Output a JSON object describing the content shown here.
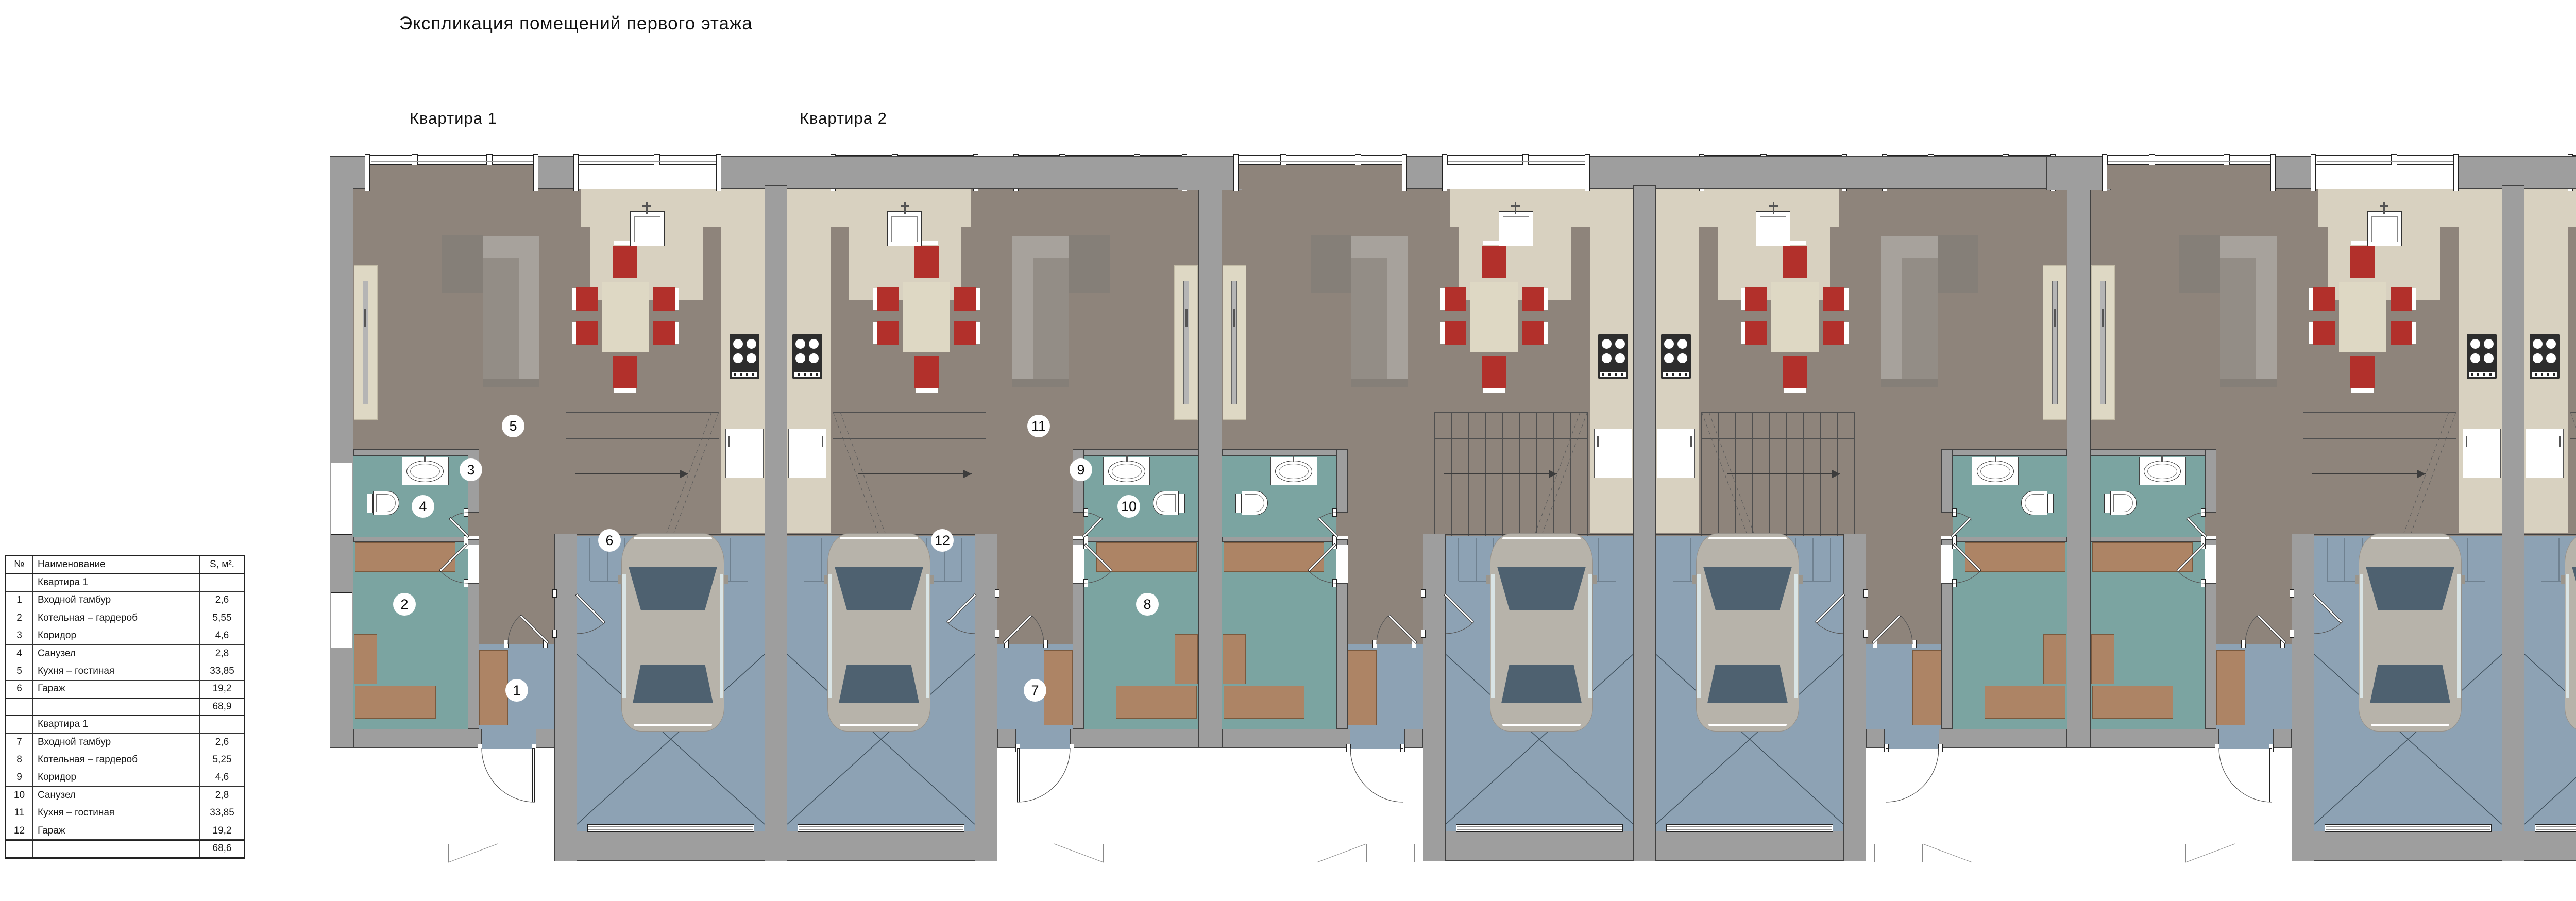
{
  "title": "Экспликация помещений первого этажа",
  "apartment_labels": [
    {
      "label": "Квартира 1"
    },
    {
      "label": "Квартира 2"
    }
  ],
  "legend_table": {
    "headers": [
      "№",
      "Наименование",
      "S, м²."
    ],
    "sections": [
      {
        "section_label": "Квартира 1",
        "rows": [
          {
            "num": "1",
            "name": "Входной тамбур",
            "area": "2,6"
          },
          {
            "num": "2",
            "name": "Котельная – гардероб",
            "area": "5,55"
          },
          {
            "num": "3",
            "name": "Коридор",
            "area": "4,6"
          },
          {
            "num": "4",
            "name": "Санузел",
            "area": "2,8"
          },
          {
            "num": "5",
            "name": "Кухня – гостиная",
            "area": "33,85"
          },
          {
            "num": "6",
            "name": "Гараж",
            "area": "19,2"
          }
        ],
        "total": "68,9"
      },
      {
        "section_label": "Квартира 1",
        "rows": [
          {
            "num": "7",
            "name": "Входной тамбур",
            "area": "2,6"
          },
          {
            "num": "8",
            "name": "Котельная – гардероб",
            "area": "5,25"
          },
          {
            "num": "9",
            "name": "Коридор",
            "area": "4,6"
          },
          {
            "num": "10",
            "name": "Санузел",
            "area": "2,8"
          },
          {
            "num": "11",
            "name": "Кухня – гостиная",
            "area": "33,85"
          },
          {
            "num": "12",
            "name": "Гараж",
            "area": "19,2"
          }
        ],
        "total": "68,6"
      }
    ]
  },
  "room_markers": {
    "unit_a": [
      "1",
      "2",
      "3",
      "4",
      "5",
      "6"
    ],
    "unit_b": [
      "7",
      "8",
      "9",
      "10",
      "11",
      "12"
    ]
  },
  "colors": {
    "wall": "#9e9e9e",
    "wall_edge": "#414141",
    "floor_living": "#8e847b",
    "floor_kitchen": "#d8d1c0",
    "floor_bath": "#7ba4a1",
    "floor_entry": "#8da2b4",
    "furniture_cream": "#ded8c4",
    "furniture_brown": "#ad8465",
    "chair_red": "#b2302b",
    "sofa_dark": "#857f78",
    "sofa_mid": "#938d86",
    "sofa_light": "#a7a29c",
    "car_body": "#b7b3aa",
    "car_glass": "#4e6170",
    "car_side_glass": "#d9e4e5",
    "stove": "#2d2d2d",
    "tv_panel": "#b5b5b5",
    "axis": "#8a8a8a"
  }
}
